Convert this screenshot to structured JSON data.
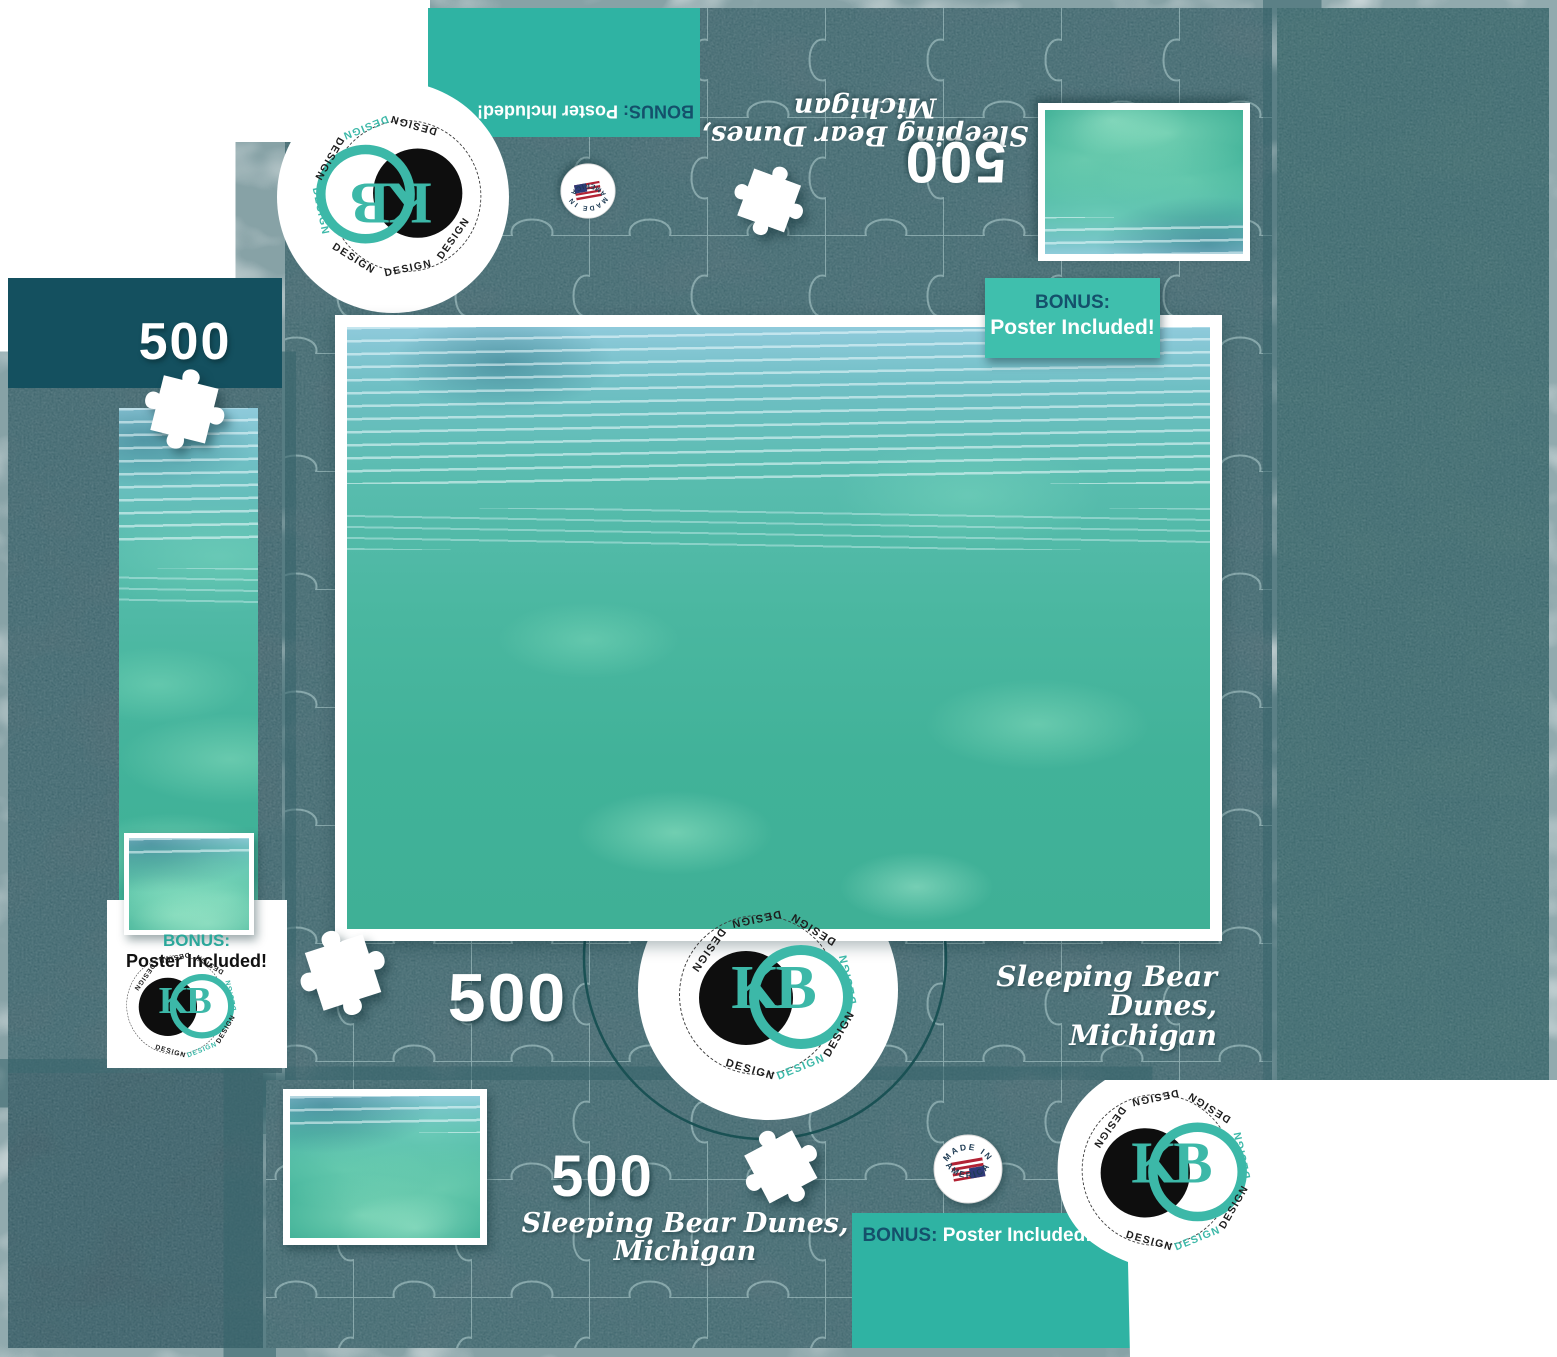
{
  "product": {
    "piece_count": "500",
    "title": "Sleeping Bear Dunes, Michigan",
    "title_line1": "Sleeping Bear Dunes,",
    "title_line2": "Michigan",
    "bonus_label": "BONUS:",
    "bonus_text": "Poster Included!"
  },
  "brand": {
    "initials": "KB",
    "ring_word": "DESIGN",
    "made_in_line1": "MADE IN",
    "made_in_line2": "AMERICA"
  },
  "colors": {
    "accent_teal": "#2fb3a3",
    "badge_teal": "#3fbfad",
    "dark_teal_band": "#14505f",
    "navy_text": "#14506b",
    "logo_teal": "#3cb8a8",
    "texture_base": "#4a6870",
    "texture_right": "#406b6d",
    "texture_left": "#47646c",
    "texture_bottom_left": "#3b5761",
    "puzzle_line": "#bfdcdc"
  }
}
